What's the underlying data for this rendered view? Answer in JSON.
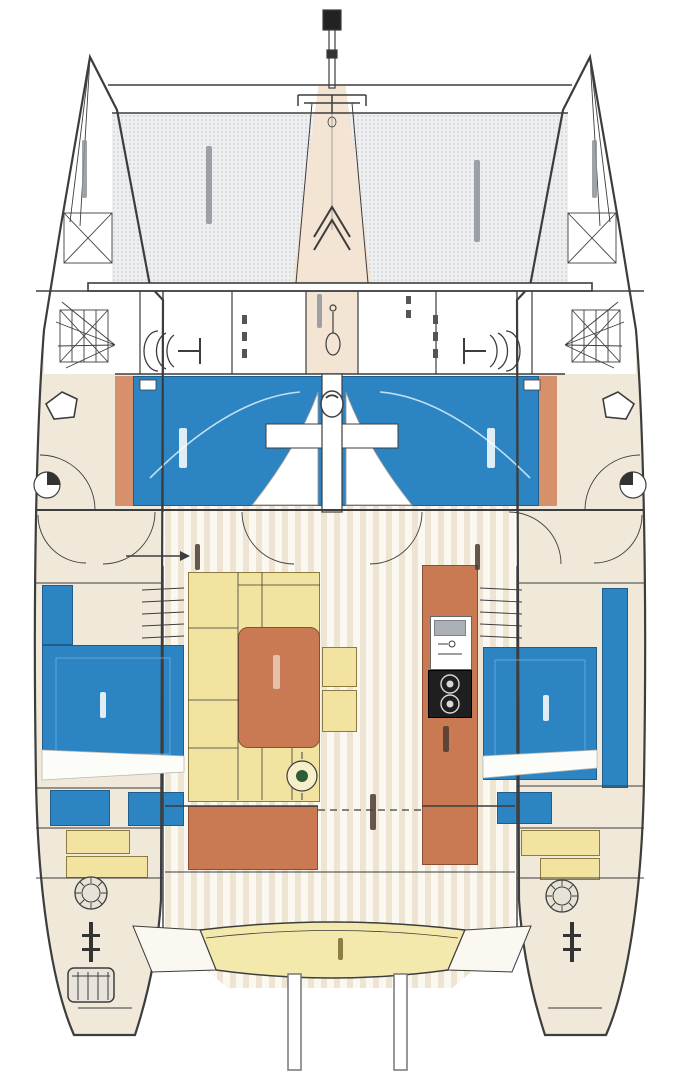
{
  "legible_text": [],
  "palette": {
    "cushion_blue": "#2c85c2",
    "wood_orange": "#c97a52",
    "salmon_strip": "#d6906b",
    "upholstery_yellow": "#f2e3a1",
    "bench_yellow": "#f4e9ad",
    "hull_tan": "#f0e8d9",
    "deck_white": "#ffffff",
    "floor_stripe_dark": "#eee4d2",
    "floor_stripe_light": "#fbf8f1",
    "trampoline_base": "#edeff1",
    "trampoline_dot": "#d3d6da",
    "walkway_tan": "#f3e4d3",
    "line_dark": "#3d3d3d",
    "line_light": "#8f8f8f",
    "white": "#ffffff",
    "pillow_white": "#fcfcf9",
    "sink_gray": "#aab0b6",
    "stove_black": "#1f1f1f",
    "burner_ring": "#d8d8d8",
    "table_green": "#2c5c38",
    "winch_fill": "#e7e2d6",
    "ladder_fill": "#e8e4db",
    "smudge_gray": "#8d939a",
    "smudge_dark": "#4a3c30",
    "smudge_light": "#e8cdbc",
    "smudge_olive": "#7a6a35",
    "seatline_blue": "#bfe0f2",
    "bed_quilt_line": "#6db0de",
    "masthead_black": "#222222"
  },
  "vessel": {
    "regions": {
      "bow_port": "port bow with anchor locker hatch",
      "bow_starboard": "starboard bow with locker hatch",
      "trampoline": "foredeck trampoline netting",
      "mast_walkway": "center walkway to mast",
      "foredeck_lockers": "forward deck locker compartments",
      "forward_lounge": "forward cockpit blue sunbed cushions",
      "mast_base": "mast support column",
      "salon": "main salon with settee and table",
      "dinette_table": "salon dining table",
      "settee": "L-shaped salon settee",
      "stools": "two salon stools",
      "cocktail_table": "round cocktail table",
      "galley_island": "galley island with sink and stove",
      "sideboard": "aft salon sideboard",
      "port_cabin": "port hull double berth cabin",
      "starboard_cabin": "starboard hull double berth cabin",
      "companionway_steps": "steps down into hulls",
      "aft_cockpit": "aft cockpit",
      "stern_bench": "aft cockpit bench seat",
      "helm_winches": "aft winch / helm pods",
      "transom_ladder": "port transom boarding ladder",
      "davits": "dinghy davit posts"
    },
    "illegible_label_marks": 14
  }
}
